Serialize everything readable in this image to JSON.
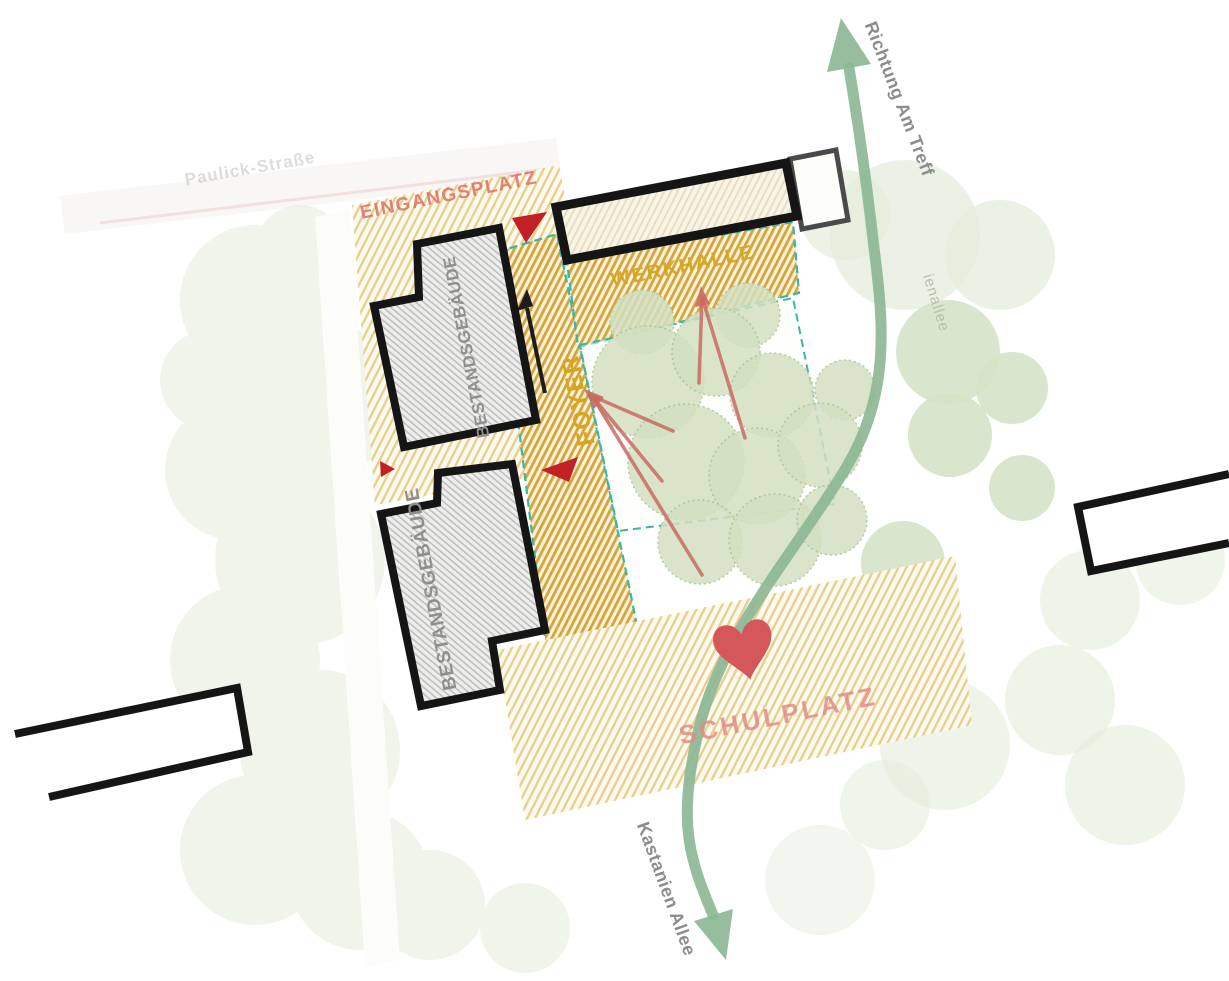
{
  "plan": {
    "areas": {
      "eingangsplatz": {
        "label": "EINGANGSPLATZ"
      },
      "werkhalle": {
        "label": "WERKHALLE"
      },
      "foyer": {
        "label": "FOYER"
      },
      "schulplatz": {
        "label": "SCHULPLATZ"
      }
    },
    "buildings": {
      "bestandsgebaeude_nord": {
        "label": "BESTANDSGEBÄUDE"
      },
      "bestandsgebaeude_sued": {
        "label": "BESTANDSGEBÄUDE"
      }
    },
    "streets": {
      "paulick_strasse": {
        "label": "Paulick-Straße"
      },
      "kastanienallee_base": {
        "label": "ienallee"
      }
    },
    "route": {
      "to_label": "Richtung Am Treff",
      "from_label": "Kastanien Allee"
    },
    "icons": {
      "schulplatz_heart": "heart-icon",
      "entrance_marker": "triangle-arrow-icon",
      "route_arrow": "double-headed-curved-arrow"
    },
    "colors": {
      "gold_light": "#e9cf8e",
      "gold_dark": "#d2a53f",
      "teal": "#3ab6a3",
      "red": "#c32026",
      "red_line": "#c96a63",
      "salmon": "#dd7066",
      "salmon2": "#e28d84",
      "gold_text": "#d7a61c",
      "gray_text": "#8f8f8f",
      "gray_text2": "#8c8c8c",
      "faint_text": "#c5c5c5",
      "faint_green_text": "#b5c0ad",
      "green_arrow": "#8cb796",
      "tree": "#d3e0c1",
      "tree_stroke": "#a9c393",
      "tree_faint": "#e4ecdb",
      "heart": "#d4585a",
      "black": "#151515"
    }
  }
}
